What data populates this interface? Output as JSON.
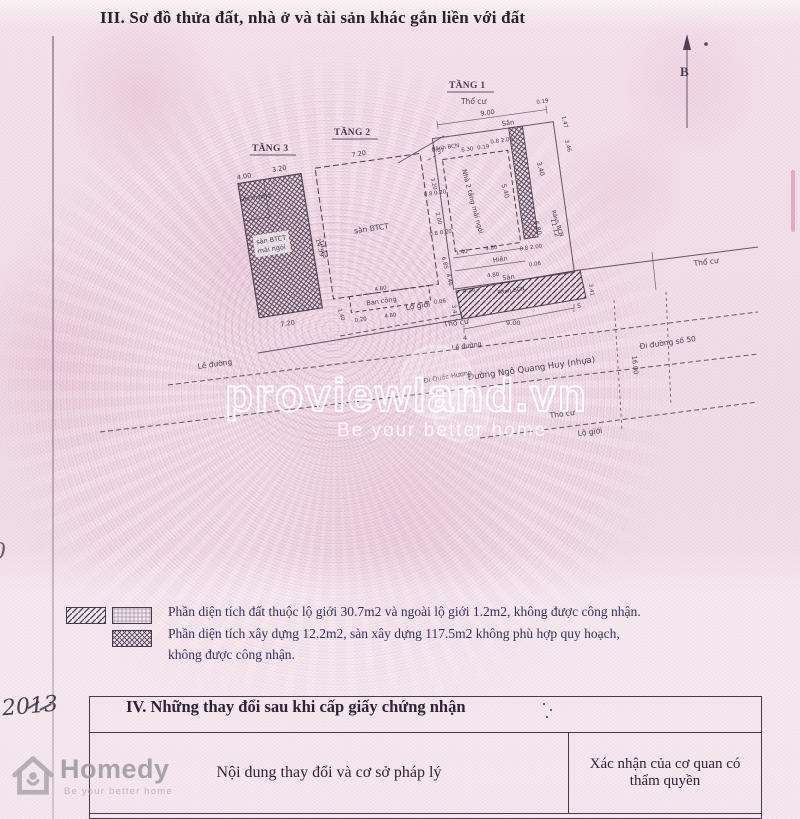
{
  "colors": {
    "paper": "#eedae5",
    "ink": "#473c50",
    "text_blue": "#35315c",
    "title_ink": "#2a2127"
  },
  "header": {
    "title": "III. Sơ đồ thửa đất, nhà ở và tài sản khác gắn liền với đất"
  },
  "compass": {
    "label": "B"
  },
  "floor3": {
    "title": "TẦNG 3",
    "terrace": "Sân thượng",
    "slab": "sàn BTCT",
    "roof": "mái ngói",
    "d1": "4.00",
    "d2": "3.20",
    "d3": "14.59",
    "d4": "7.20"
  },
  "floor2": {
    "title": "TẦNG 2",
    "slab": "sàn BTCT",
    "balcony": "Ban công",
    "d_top": "7.20",
    "d_gap": "0.07",
    "d_left": "14.13",
    "r1": "3.20",
    "r2": "0.8 0.20",
    "r3": "2.00",
    "r4": "0.8 0.20",
    "r5": "6.85",
    "b1": "1.40",
    "b2": "4.80",
    "b3": "0.20",
    "b4": "4.80",
    "b5": "0.06"
  },
  "floor1": {
    "title": "TẦNG 1",
    "zone": "Thổ cư",
    "d900": "9.00",
    "d019a": "0.19",
    "ranh_l": "Rãnh BCN",
    "d630": "6.30",
    "d019b": "0.19",
    "d082a": "0.8 2.00",
    "san_top": "Sân",
    "house": "Nhà 2 tầng mái ngói",
    "d540": "5.40",
    "d340": "3.40",
    "ranh_r": "Rãnh BCN",
    "d082b": "0.8 2.00",
    "d147": "1.47",
    "d346": "3.46",
    "d680": "6.80",
    "d1112": "11.12",
    "d140": "1.40",
    "d480a": "4.80",
    "hien": "Hiên",
    "d480b": "4.80",
    "d006": "0.06",
    "san": "Sân",
    "d020": "0.20",
    "ranh_b": "Rãnh BCN",
    "d446": "4.46"
  },
  "street": {
    "lo_gioi1": "Lộ giới",
    "tho_cu1": "Thổ cư",
    "d341a": "3.41",
    "d341b": "3.41",
    "d4": "4",
    "d900": "9.00",
    "d5": "5",
    "tho_cu2": "Thổ cư",
    "le_duong1": "Lề đường",
    "le_duong2": "Lề đường",
    "di_quoc_huong": "Đi Quốc Hương",
    "name": "Đường Ngô Quang Huy (nhựa)",
    "d1600": "16.00",
    "di_duong50": "Đi đường số 50",
    "tho_cu3": "Thổ cư",
    "lo_gioi2": "Lộ giới"
  },
  "legend": {
    "line1": "Phần diện tích đất thuộc lộ giới 30.7m2 và ngoài lộ giới 1.2m2, không được công nhận.",
    "line2": "Phần diện tích xây dựng 12.2m2, sàn xây dựng 117.5m2 không phù hợp quy hoạch,",
    "line3": "không được công nhận."
  },
  "section4": {
    "title": "IV. Những thay đổi sau khi cấp giấy chứng nhận",
    "col_content": "Nội dung thay đổi và cơ sở pháp lý",
    "col_confirm": "Xác nhận của cơ quan có thẩm quyền"
  },
  "watermark": {
    "brand": "proviewland.vn",
    "tagline": "Be your better home"
  },
  "homedy": {
    "brand": "Homedy",
    "tagline": "Be your better home"
  },
  "handwriting": {
    "year": "2013",
    "left_mark": "0"
  }
}
